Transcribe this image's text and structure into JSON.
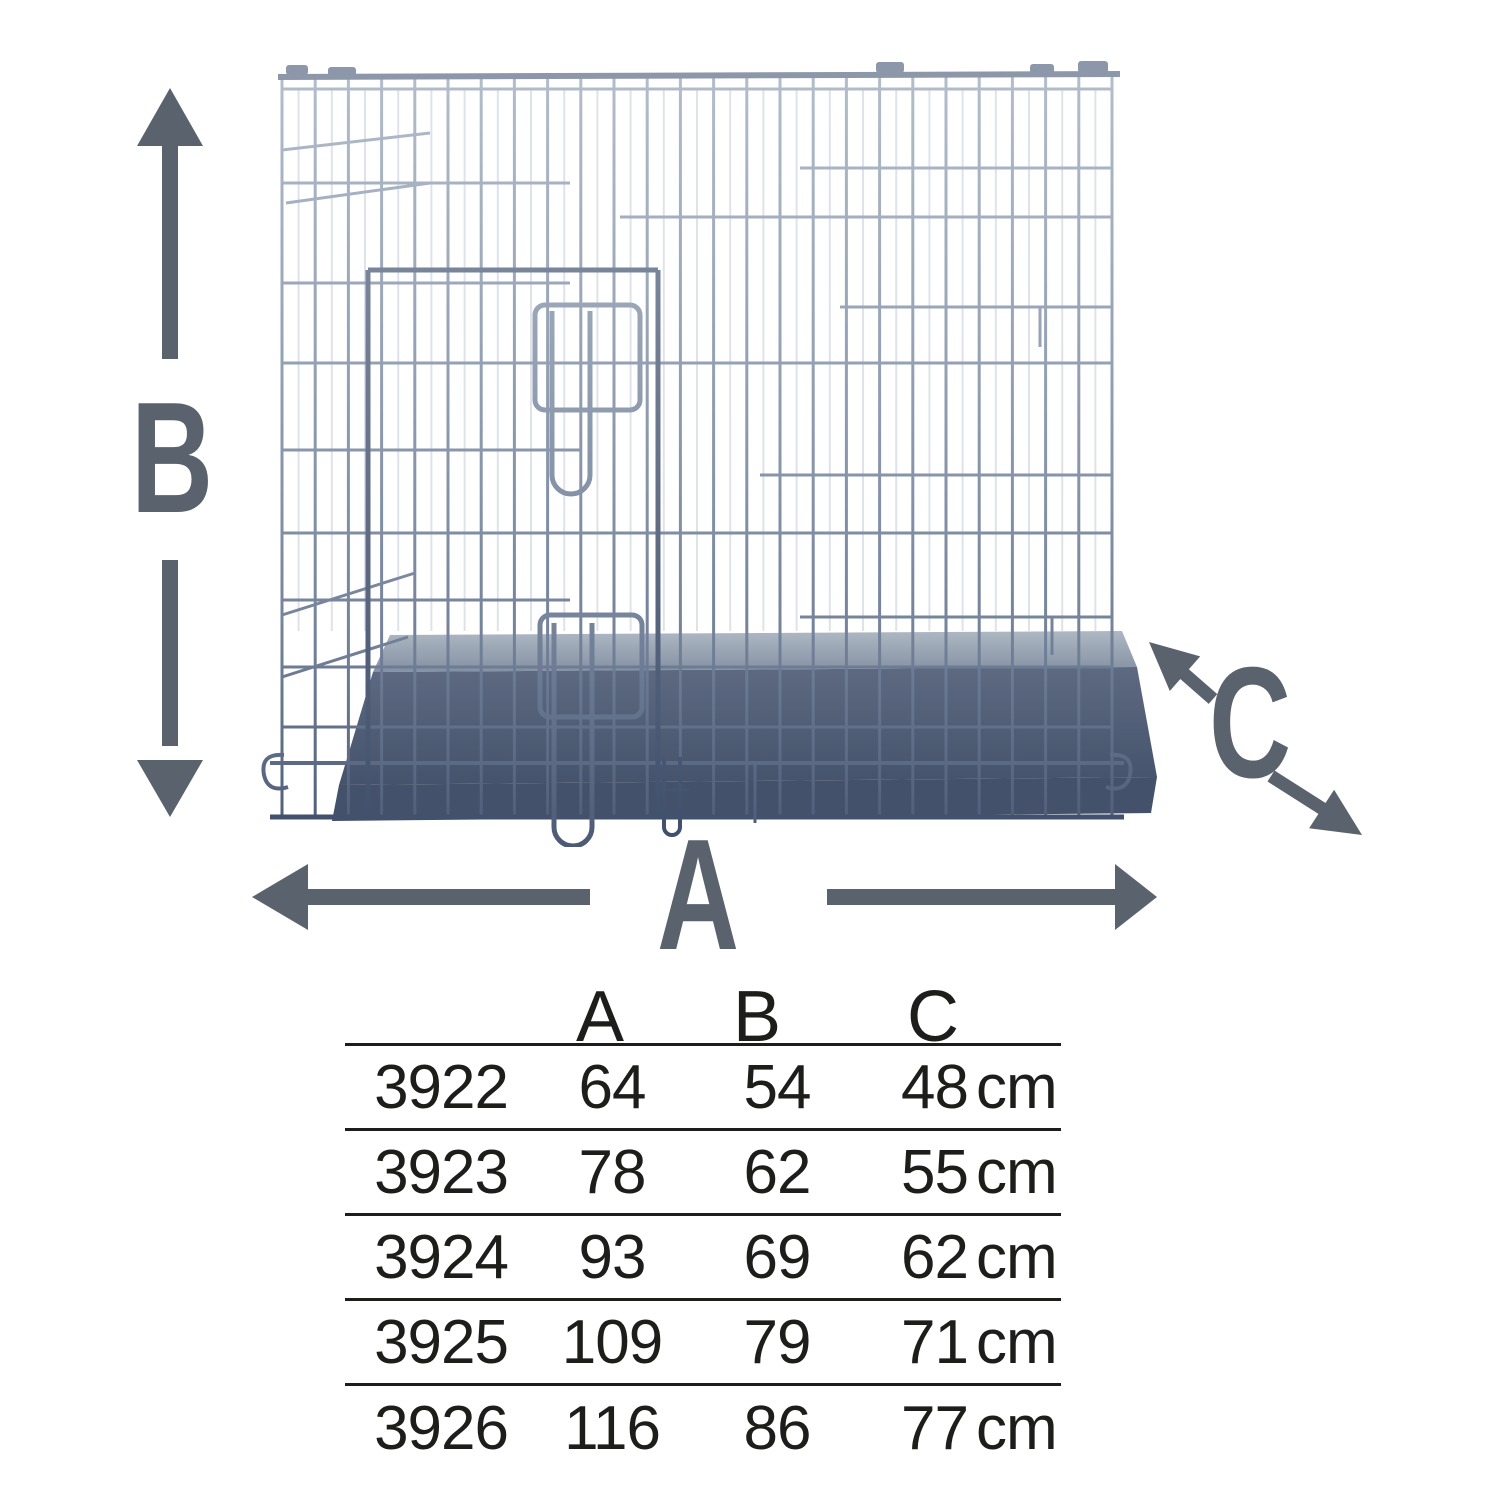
{
  "diagram": {
    "subject": "wire-dog-crate-with-metal-tray",
    "labels": {
      "a": "A",
      "b": "B",
      "c": "C"
    }
  },
  "table": {
    "headers": [
      "A",
      "B",
      "C"
    ],
    "unit": "cm",
    "rows": [
      {
        "article": "3922",
        "a": "64",
        "b": "54",
        "c": "48"
      },
      {
        "article": "3923",
        "a": "78",
        "b": "62",
        "c": "55"
      },
      {
        "article": "3924",
        "a": "93",
        "b": "69",
        "c": "62"
      },
      {
        "article": "3925",
        "a": "109",
        "b": "79",
        "c": "71"
      },
      {
        "article": "3926",
        "a": "116",
        "b": "86",
        "c": "77"
      }
    ]
  },
  "colors": {
    "dimension_gray": "#5a626e",
    "table_text": "#1d1d1b",
    "wire_light": "#b5bfcc",
    "wire_dark": "#4c5a76",
    "tray_dark": "#44516a",
    "background": "#ffffff"
  }
}
